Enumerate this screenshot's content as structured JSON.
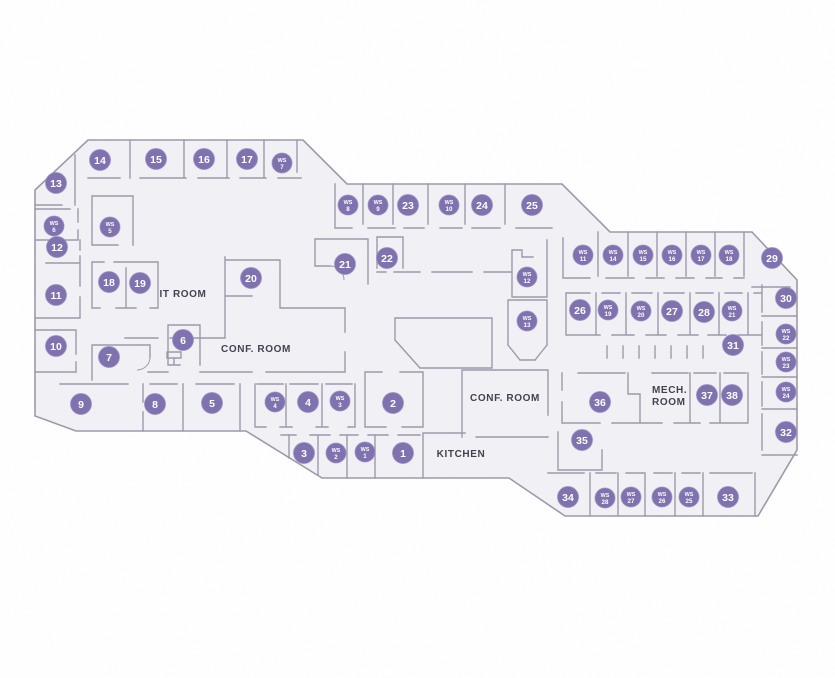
{
  "canvas": {
    "width": 835,
    "height": 678,
    "background": "#ffffff"
  },
  "palette": {
    "floor_fill": "#f2f1f6",
    "wall_color": "#9d98a8",
    "marker_fill": "#7e70ae",
    "marker_edge": "#988cc2",
    "marker_text": "#ffffff",
    "label_color": "#423d4c"
  },
  "room_labels": [
    {
      "text": "IT ROOM",
      "x": 183,
      "y": 297,
      "anchor": "middle"
    },
    {
      "text": "CONF. ROOM",
      "x": 256,
      "y": 352,
      "anchor": "middle"
    },
    {
      "text": "CONF. ROOM",
      "x": 505,
      "y": 401,
      "anchor": "middle"
    },
    {
      "text": "KITCHEN",
      "x": 461,
      "y": 457,
      "anchor": "middle"
    },
    {
      "text": "MECH.",
      "x": 652,
      "y": 393,
      "anchor": "start"
    },
    {
      "text": "ROOM",
      "x": 652,
      "y": 405,
      "anchor": "start"
    }
  ],
  "numbered_markers": [
    {
      "label": "1",
      "x": 403,
      "y": 453
    },
    {
      "label": "2",
      "x": 393,
      "y": 403
    },
    {
      "label": "3",
      "x": 304,
      "y": 453
    },
    {
      "label": "4",
      "x": 308,
      "y": 402
    },
    {
      "label": "5",
      "x": 212,
      "y": 403
    },
    {
      "label": "6",
      "x": 183,
      "y": 340
    },
    {
      "label": "7",
      "x": 109,
      "y": 357
    },
    {
      "label": "8",
      "x": 155,
      "y": 404
    },
    {
      "label": "9",
      "x": 81,
      "y": 404
    },
    {
      "label": "10",
      "x": 56,
      "y": 346
    },
    {
      "label": "11",
      "x": 56,
      "y": 295
    },
    {
      "label": "12",
      "x": 57,
      "y": 247
    },
    {
      "label": "13",
      "x": 56,
      "y": 183
    },
    {
      "label": "14",
      "x": 100,
      "y": 160
    },
    {
      "label": "15",
      "x": 156,
      "y": 159
    },
    {
      "label": "16",
      "x": 204,
      "y": 159
    },
    {
      "label": "17",
      "x": 247,
      "y": 159
    },
    {
      "label": "18",
      "x": 109,
      "y": 282
    },
    {
      "label": "19",
      "x": 140,
      "y": 283
    },
    {
      "label": "20",
      "x": 251,
      "y": 278
    },
    {
      "label": "21",
      "x": 345,
      "y": 264
    },
    {
      "label": "22",
      "x": 387,
      "y": 258
    },
    {
      "label": "23",
      "x": 408,
      "y": 205
    },
    {
      "label": "24",
      "x": 482,
      "y": 205
    },
    {
      "label": "25",
      "x": 532,
      "y": 205
    },
    {
      "label": "26",
      "x": 580,
      "y": 310
    },
    {
      "label": "27",
      "x": 672,
      "y": 311
    },
    {
      "label": "28",
      "x": 704,
      "y": 312
    },
    {
      "label": "29",
      "x": 772,
      "y": 258
    },
    {
      "label": "30",
      "x": 786,
      "y": 298
    },
    {
      "label": "31",
      "x": 733,
      "y": 345
    },
    {
      "label": "32",
      "x": 786,
      "y": 432
    },
    {
      "label": "33",
      "x": 728,
      "y": 497
    },
    {
      "label": "34",
      "x": 568,
      "y": 497
    },
    {
      "label": "35",
      "x": 582,
      "y": 440
    },
    {
      "label": "36",
      "x": 600,
      "y": 402
    },
    {
      "label": "37",
      "x": 707,
      "y": 395
    },
    {
      "label": "38",
      "x": 732,
      "y": 395
    }
  ],
  "ws_markers": [
    {
      "label": "WS",
      "number": "1",
      "x": 365,
      "y": 452
    },
    {
      "label": "WS",
      "number": "2",
      "x": 336,
      "y": 453
    },
    {
      "label": "WS",
      "number": "3",
      "x": 340,
      "y": 401
    },
    {
      "label": "WS",
      "number": "4",
      "x": 275,
      "y": 402
    },
    {
      "label": "WS",
      "number": "5",
      "x": 110,
      "y": 227
    },
    {
      "label": "WS",
      "number": "6",
      "x": 54,
      "y": 226
    },
    {
      "label": "WS",
      "number": "7",
      "x": 282,
      "y": 163
    },
    {
      "label": "WS",
      "number": "8",
      "x": 348,
      "y": 205
    },
    {
      "label": "WS",
      "number": "9",
      "x": 378,
      "y": 205
    },
    {
      "label": "WS",
      "number": "10",
      "x": 449,
      "y": 205
    },
    {
      "label": "WS",
      "number": "11",
      "x": 583,
      "y": 255
    },
    {
      "label": "WS",
      "number": "12",
      "x": 527,
      "y": 277
    },
    {
      "label": "WS",
      "number": "13",
      "x": 527,
      "y": 321
    },
    {
      "label": "WS",
      "number": "14",
      "x": 613,
      "y": 255
    },
    {
      "label": "WS",
      "number": "15",
      "x": 643,
      "y": 255
    },
    {
      "label": "WS",
      "number": "16",
      "x": 672,
      "y": 255
    },
    {
      "label": "WS",
      "number": "17",
      "x": 701,
      "y": 255
    },
    {
      "label": "WS",
      "number": "18",
      "x": 729,
      "y": 255
    },
    {
      "label": "WS",
      "number": "19",
      "x": 608,
      "y": 310
    },
    {
      "label": "WS",
      "number": "20",
      "x": 641,
      "y": 311
    },
    {
      "label": "WS",
      "number": "21",
      "x": 732,
      "y": 311
    },
    {
      "label": "WS",
      "number": "22",
      "x": 786,
      "y": 334
    },
    {
      "label": "WS",
      "number": "23",
      "x": 786,
      "y": 362
    },
    {
      "label": "WS",
      "number": "24",
      "x": 786,
      "y": 392
    },
    {
      "label": "WS",
      "number": "25",
      "x": 689,
      "y": 497
    },
    {
      "label": "WS",
      "number": "26",
      "x": 662,
      "y": 497
    },
    {
      "label": "WS",
      "number": "27",
      "x": 631,
      "y": 497
    },
    {
      "label": "WS",
      "number": "28",
      "x": 605,
      "y": 498
    }
  ]
}
